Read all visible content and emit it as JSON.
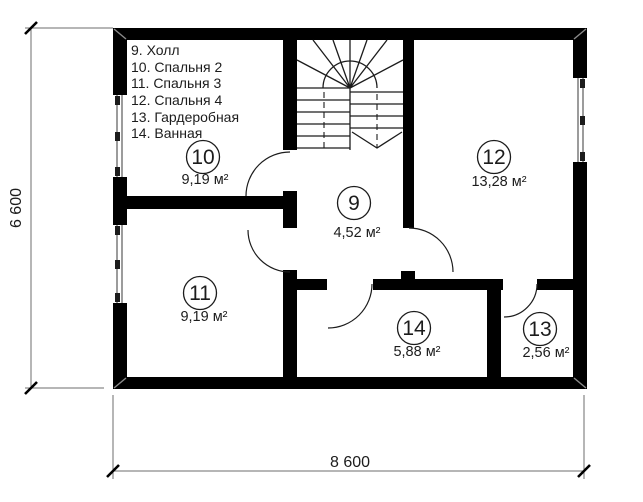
{
  "legend": {
    "items": [
      "9. Холл",
      "10. Спальня 2",
      "11. Спальня 3",
      "12. Спальня 4",
      "13. Гардеробная",
      "14. Ванная"
    ]
  },
  "rooms": [
    {
      "id": "hall",
      "number": "9",
      "name": "Холл",
      "area": "4,52 м²"
    },
    {
      "id": "bedroom-2",
      "number": "10",
      "name": "Спальня 2",
      "area": "9,19 м²"
    },
    {
      "id": "bedroom-3",
      "number": "11",
      "name": "Спальня 3",
      "area": "9,19 м²"
    },
    {
      "id": "bedroom-4",
      "number": "12",
      "name": "Спальня 4",
      "area": "13,28 м²"
    },
    {
      "id": "wardrobe",
      "number": "13",
      "name": "Гардеробная",
      "area": "2,56 м²"
    },
    {
      "id": "bathroom",
      "number": "14",
      "name": "Ванная",
      "area": "5,88 м²"
    }
  ],
  "dimensions": {
    "overall_width": "8 600",
    "overall_height": "6 600"
  },
  "colors": {
    "wall": "#000000",
    "line": "#1c1c1c",
    "dimension_line": "#6e6e6e",
    "background": "#ffffff"
  }
}
